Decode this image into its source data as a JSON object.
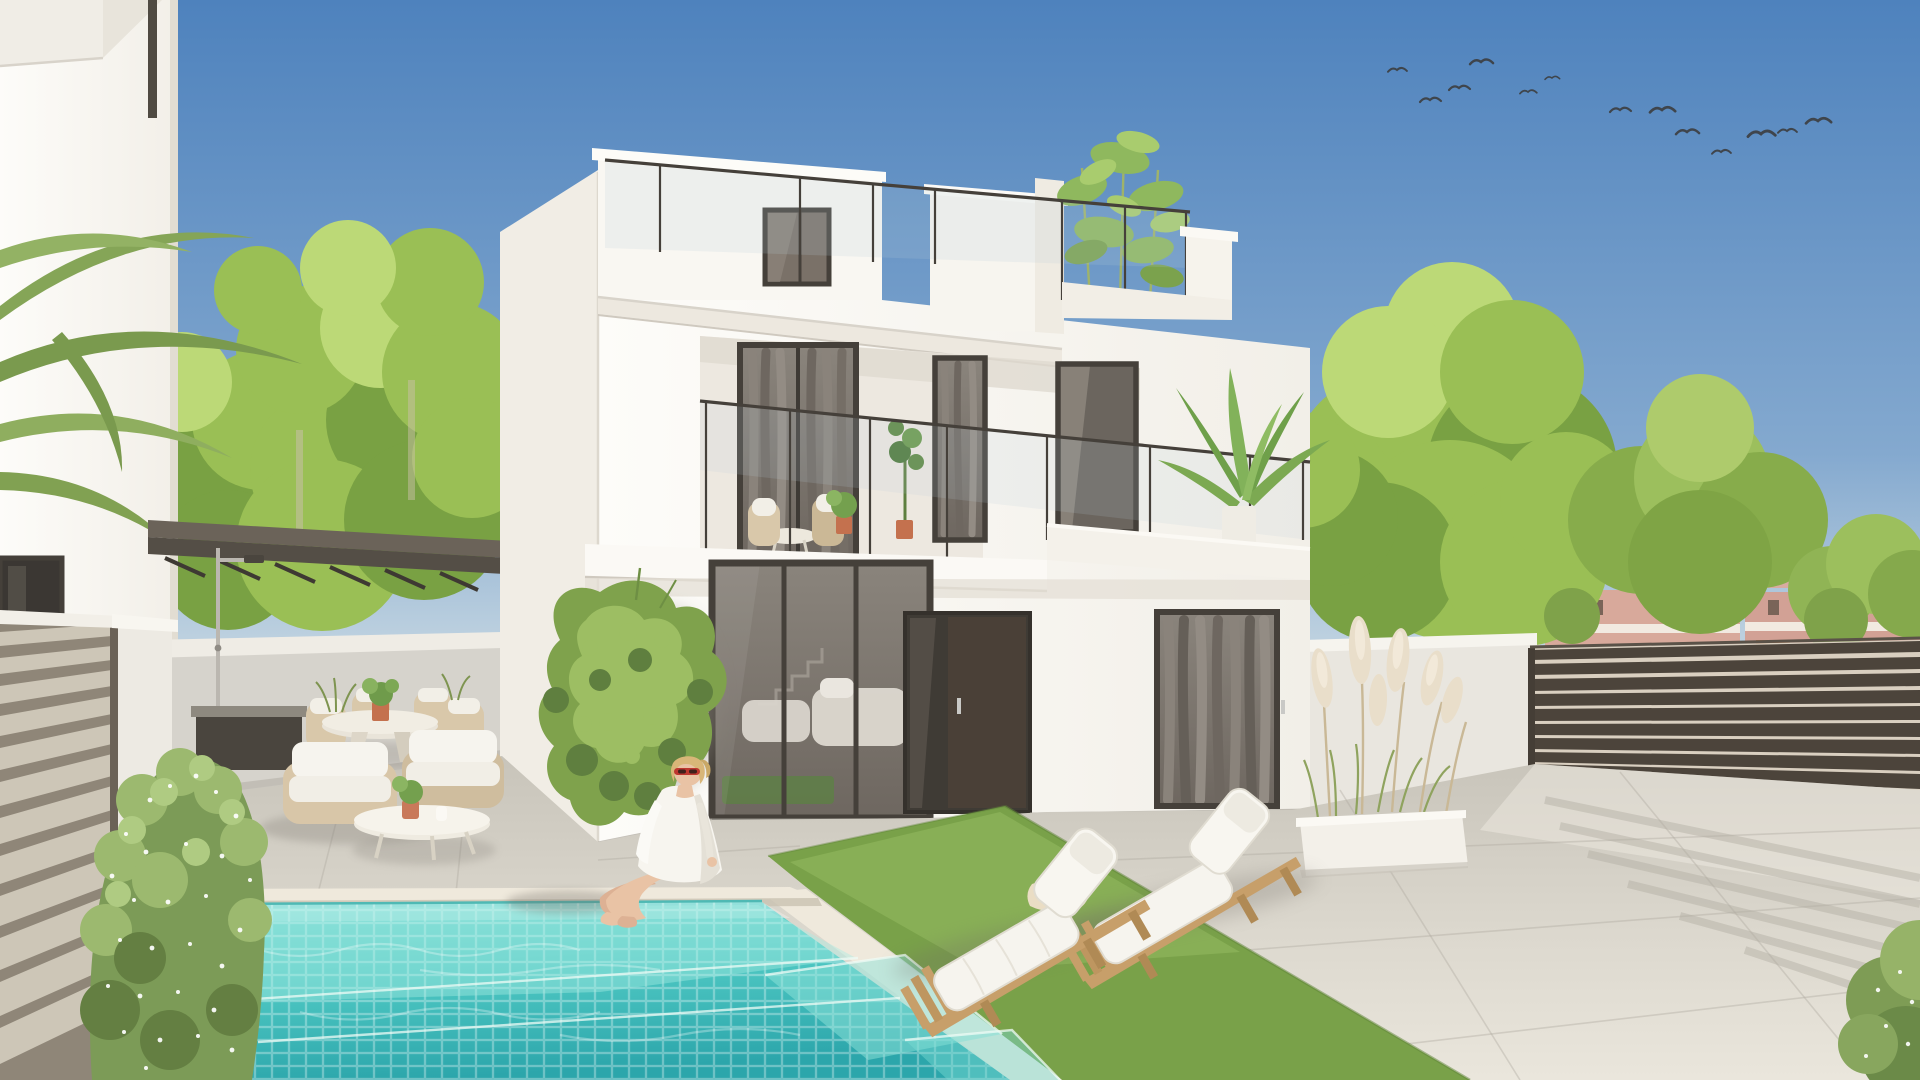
{
  "meta": {
    "kind": "photorealistic exterior architectural render",
    "subject": "modern two-storey white villa with roof terrace, private mosaic pool, sun loungers and landscaped patio",
    "sky": "clear blue, flock of birds upper right",
    "people_count": 1,
    "sun_lounger_count": 2,
    "bird_count": 13
  },
  "palette": {
    "sky_top": "#4E82BD",
    "sky_mid": "#84A9CF",
    "sky_low": "#C6D7E2",
    "sky_horizon": "#EEF0EC",
    "wall_bright": "#F8F6F1",
    "wall_light": "#F2EFE8",
    "wall_shade": "#E7E2D8",
    "slab_white": "#FBF9F5",
    "groove": "#D8D3CA",
    "frame_dark": "#45403A",
    "glass_dark": "#6E6760",
    "glass_sky": "#B8CCD9",
    "curtain": "#8A837B",
    "curtain_dark": "#625C55",
    "door_brown": "#4A4037",
    "patio_wall": "#D6D3CC",
    "pergola_top": "#6B6359",
    "pergola_face": "#544E46",
    "pool_shallow": "#7ADBD3",
    "pool_mid": "#4FC8C3",
    "pool_deep": "#2CA6AB",
    "coping": "#EFE9DC",
    "grout": "#FFFFFF",
    "paving_far": "#C8C4BA",
    "paving_near": "#EAE6DC",
    "grass": "#79A149",
    "grass_light": "#95BB60",
    "tree_base": "#9ABF55",
    "tree_dark": "#79A143",
    "tree_light": "#BCD977",
    "fence_dark": "#4C443B",
    "fence_gap": "#D9CFC0",
    "fence_light": "#CDC6B7",
    "fence_light_gap": "#8F8678",
    "far_wall": "#D8A99B",
    "far_roof": "#996B50",
    "far_trim": "#F2EAE1",
    "pampas": "#E9DECA",
    "planter": "#F3F0E9",
    "wood": "#C79F6A",
    "wood_dark": "#B08A55",
    "cushion": "#F6F4EE",
    "rattan": "#D9C8AA",
    "skin": "#E9C3A5",
    "hair": "#D8B678",
    "shirt": "#F7F5EF",
    "sunglasses": "#BE372F",
    "terracotta": "#C4714E",
    "rug_green": "#5E7F46",
    "ivy_dark": "#5F7F3F",
    "ivy_mid": "#7FA24C",
    "ivy_light": "#9DBE63",
    "chrome": "#BBB7B0",
    "bird": "#3B3B3B",
    "shadow": "#6F6B63"
  },
  "scene": {
    "birds": [
      {
        "x": 1388,
        "y": 70,
        "s": 0.9
      },
      {
        "x": 1420,
        "y": 100,
        "s": 1.0
      },
      {
        "x": 1449,
        "y": 88,
        "s": 1.0
      },
      {
        "x": 1470,
        "y": 62,
        "s": 1.1
      },
      {
        "x": 1520,
        "y": 92,
        "s": 0.8
      },
      {
        "x": 1545,
        "y": 78,
        "s": 0.7
      },
      {
        "x": 1610,
        "y": 110,
        "s": 1.0
      },
      {
        "x": 1650,
        "y": 110,
        "s": 1.2
      },
      {
        "x": 1676,
        "y": 132,
        "s": 1.1
      },
      {
        "x": 1712,
        "y": 152,
        "s": 0.9
      },
      {
        "x": 1748,
        "y": 134,
        "s": 1.3
      },
      {
        "x": 1778,
        "y": 131,
        "s": 0.9
      },
      {
        "x": 1806,
        "y": 121,
        "s": 1.2
      }
    ]
  }
}
